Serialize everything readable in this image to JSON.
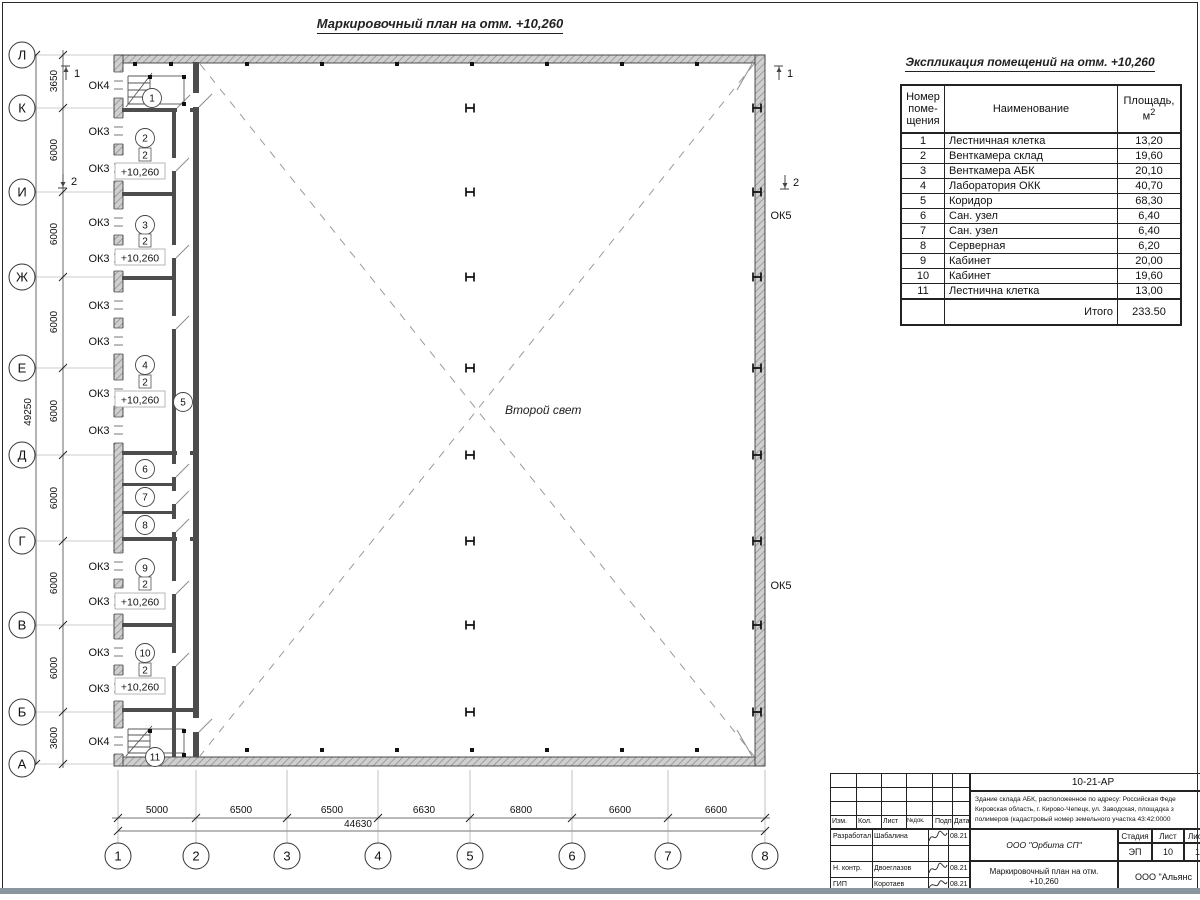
{
  "sheet": {
    "title": "Маркировочный план на отм. +10,260",
    "table_title": "Экспликация помещений на отм. +10,260"
  },
  "plan": {
    "second_light": {
      "label": "Второй свет",
      "x": 505,
      "y": 414
    },
    "axes_rows": [
      {
        "label": "Л",
        "y": 55
      },
      {
        "label": "К",
        "y": 108
      },
      {
        "label": "И",
        "y": 192
      },
      {
        "label": "Ж",
        "y": 277
      },
      {
        "label": "Е",
        "y": 368
      },
      {
        "label": "Д",
        "y": 455
      },
      {
        "label": "Г",
        "y": 541
      },
      {
        "label": "В",
        "y": 625
      },
      {
        "label": "Б",
        "y": 712
      },
      {
        "label": "А",
        "y": 764
      }
    ],
    "axes_cols": [
      {
        "label": "1",
        "x": 118
      },
      {
        "label": "2",
        "x": 196
      },
      {
        "label": "3",
        "x": 287
      },
      {
        "label": "4",
        "x": 378
      },
      {
        "label": "5",
        "x": 470
      },
      {
        "label": "6",
        "x": 572
      },
      {
        "label": "7",
        "x": 668
      },
      {
        "label": "8",
        "x": 765
      }
    ],
    "dims_rows": [
      {
        "label": "3650",
        "y": 81
      },
      {
        "label": "6000",
        "y": 150
      },
      {
        "label": "6000",
        "y": 234
      },
      {
        "label": "6000",
        "y": 322
      },
      {
        "label": "6000",
        "y": 411
      },
      {
        "label": "6000",
        "y": 498
      },
      {
        "label": "6000",
        "y": 583
      },
      {
        "label": "6000",
        "y": 668
      },
      {
        "label": "3600",
        "y": 738
      }
    ],
    "dims_cols": [
      {
        "label": "5000",
        "x": 157
      },
      {
        "label": "6500",
        "x": 241
      },
      {
        "label": "6500",
        "x": 332
      },
      {
        "label": "6630",
        "x": 424
      },
      {
        "label": "6800",
        "x": 521
      },
      {
        "label": "6600",
        "x": 620
      },
      {
        "label": "6600",
        "x": 716
      }
    ],
    "total_row": {
      "label": "49250",
      "x": 31,
      "y": 412
    },
    "total_col": {
      "label": "44630",
      "x": 358,
      "y": 827
    },
    "window_marks": [
      {
        "label": "ОК4",
        "x": 99,
        "y": 85
      },
      {
        "label": "ОК3",
        "x": 99,
        "y": 131
      },
      {
        "label": "ОК3",
        "x": 99,
        "y": 168
      },
      {
        "label": "ОК3",
        "x": 99,
        "y": 222
      },
      {
        "label": "ОК3",
        "x": 99,
        "y": 258
      },
      {
        "label": "ОК3",
        "x": 99,
        "y": 305
      },
      {
        "label": "ОК3",
        "x": 99,
        "y": 341
      },
      {
        "label": "ОК3",
        "x": 99,
        "y": 393
      },
      {
        "label": "ОК3",
        "x": 99,
        "y": 430
      },
      {
        "label": "ОК3",
        "x": 99,
        "y": 566
      },
      {
        "label": "ОК3",
        "x": 99,
        "y": 601
      },
      {
        "label": "ОК3",
        "x": 99,
        "y": 652
      },
      {
        "label": "ОК3",
        "x": 99,
        "y": 688
      },
      {
        "label": "ОК4",
        "x": 99,
        "y": 741
      },
      {
        "label": "ОК5",
        "x": 781,
        "y": 215
      },
      {
        "label": "ОК5",
        "x": 781,
        "y": 585
      }
    ],
    "rooms": [
      {
        "n": "1",
        "x": 152,
        "y": 98
      },
      {
        "n": "2",
        "x": 145,
        "y": 138
      },
      {
        "n": "3",
        "x": 145,
        "y": 225
      },
      {
        "n": "4",
        "x": 145,
        "y": 365
      },
      {
        "n": "5",
        "x": 183,
        "y": 402
      },
      {
        "n": "6",
        "x": 145,
        "y": 469
      },
      {
        "n": "7",
        "x": 145,
        "y": 497
      },
      {
        "n": "8",
        "x": 145,
        "y": 525
      },
      {
        "n": "9",
        "x": 145,
        "y": 568
      },
      {
        "n": "10",
        "x": 145,
        "y": 653
      },
      {
        "n": "11",
        "x": 155,
        "y": 757
      }
    ],
    "finish_marks": [
      {
        "label": "2",
        "x": 145,
        "y": 155
      },
      {
        "label": "2",
        "x": 145,
        "y": 241
      },
      {
        "label": "2",
        "x": 145,
        "y": 382
      },
      {
        "label": "2",
        "x": 145,
        "y": 584
      },
      {
        "label": "2",
        "x": 145,
        "y": 670
      }
    ],
    "elevations": [
      {
        "label": "+10,260",
        "x": 140,
        "y": 172
      },
      {
        "label": "+10,260",
        "x": 140,
        "y": 258
      },
      {
        "label": "+10,260",
        "x": 140,
        "y": 400
      },
      {
        "label": "+10,260",
        "x": 140,
        "y": 602
      },
      {
        "label": "+10,260",
        "x": 140,
        "y": 687
      }
    ],
    "sections": [
      {
        "label": "1",
        "x": 66,
        "y": 73,
        "dir": "up"
      },
      {
        "label": "2",
        "x": 63,
        "y": 181,
        "dir": "down"
      },
      {
        "label": "1",
        "x": 779,
        "y": 73,
        "dir": "up"
      },
      {
        "label": "2",
        "x": 785,
        "y": 182,
        "dir": "down"
      }
    ],
    "h_cols_x": [
      470,
      757
    ],
    "h_cols_y": [
      108,
      192,
      277,
      368,
      455,
      541,
      625,
      712
    ],
    "squares": [
      [
        247,
        64
      ],
      [
        322,
        64
      ],
      [
        397,
        64
      ],
      [
        472,
        64
      ],
      [
        547,
        64
      ],
      [
        622,
        64
      ],
      [
        697,
        64
      ],
      [
        247,
        750
      ],
      [
        322,
        750
      ],
      [
        397,
        750
      ],
      [
        472,
        750
      ],
      [
        547,
        750
      ],
      [
        622,
        750
      ],
      [
        697,
        750
      ],
      [
        135,
        64
      ],
      [
        171,
        64
      ],
      [
        150,
        77
      ],
      [
        184,
        77
      ],
      [
        150,
        104
      ],
      [
        184,
        104
      ],
      [
        150,
        731
      ],
      [
        184,
        731
      ],
      [
        150,
        755
      ],
      [
        184,
        755
      ]
    ],
    "window_ys": [
      85,
      131,
      168,
      222,
      258,
      305,
      341,
      393,
      430,
      566,
      601,
      652,
      688,
      741
    ]
  },
  "table": {
    "col_headers": [
      "Номер поме- щения",
      "Наименование",
      "Площадь, м2"
    ],
    "rows": [
      {
        "num": "1",
        "name": "Лестничная клетка",
        "area": "13,20"
      },
      {
        "num": "2",
        "name": "Венткамера склад",
        "area": "19,60"
      },
      {
        "num": "3",
        "name": "Венткамера АБК",
        "area": "20,10"
      },
      {
        "num": "4",
        "name": "Лаборатория ОКК",
        "area": "40,70"
      },
      {
        "num": "5",
        "name": "Коридор",
        "area": "68,30"
      },
      {
        "num": "6",
        "name": "Сан. узел",
        "area": "6,40"
      },
      {
        "num": "7",
        "name": "Сан. узел",
        "area": "6,40"
      },
      {
        "num": "8",
        "name": "Серверная",
        "area": "6,20"
      },
      {
        "num": "9",
        "name": "Кабинет",
        "area": "20,00"
      },
      {
        "num": "10",
        "name": "Кабинет",
        "area": "19,60"
      },
      {
        "num": "11",
        "name": "Лестнична клетка",
        "area": "13,00"
      }
    ],
    "total_label": "Итого",
    "total_value": "233.50"
  },
  "stamp": {
    "doc_number": "10-21-АР",
    "address_lines": [
      "Здание склада АБК, расположенное по адресу: Российская Феде",
      "Кировская область, г. Кирово-Чепецк, ул. Заводская, площадка з",
      "полимеров (кадастровый номер земельного участка 43:42:0000"
    ],
    "header_cells": [
      "Изм.",
      "Кол.",
      "Лист",
      "№док.",
      "Подп.",
      "Дата"
    ],
    "rows": [
      {
        "role": "Разработал",
        "name": "Шабалина",
        "date": "08.21",
        "sig": true
      },
      {
        "role": "",
        "name": "",
        "date": "",
        "sig": false
      },
      {
        "role": "Н. контр.",
        "name": "Двоеглазов",
        "date": "08.21",
        "sig": true
      },
      {
        "role": "ГИП",
        "name": "Коротаев",
        "date": "08.21",
        "sig": true
      }
    ],
    "org": "ООО \"Орбита СП\"",
    "stage_label": "Стадия",
    "sheet_label": "Лист",
    "sheets_label": "Листов",
    "stage": "ЭП",
    "sheet": "10",
    "sheets": "1",
    "title_lines": [
      "Маркировочный план на отм.",
      "+10,260"
    ],
    "company": "ООО \"Альянс"
  }
}
